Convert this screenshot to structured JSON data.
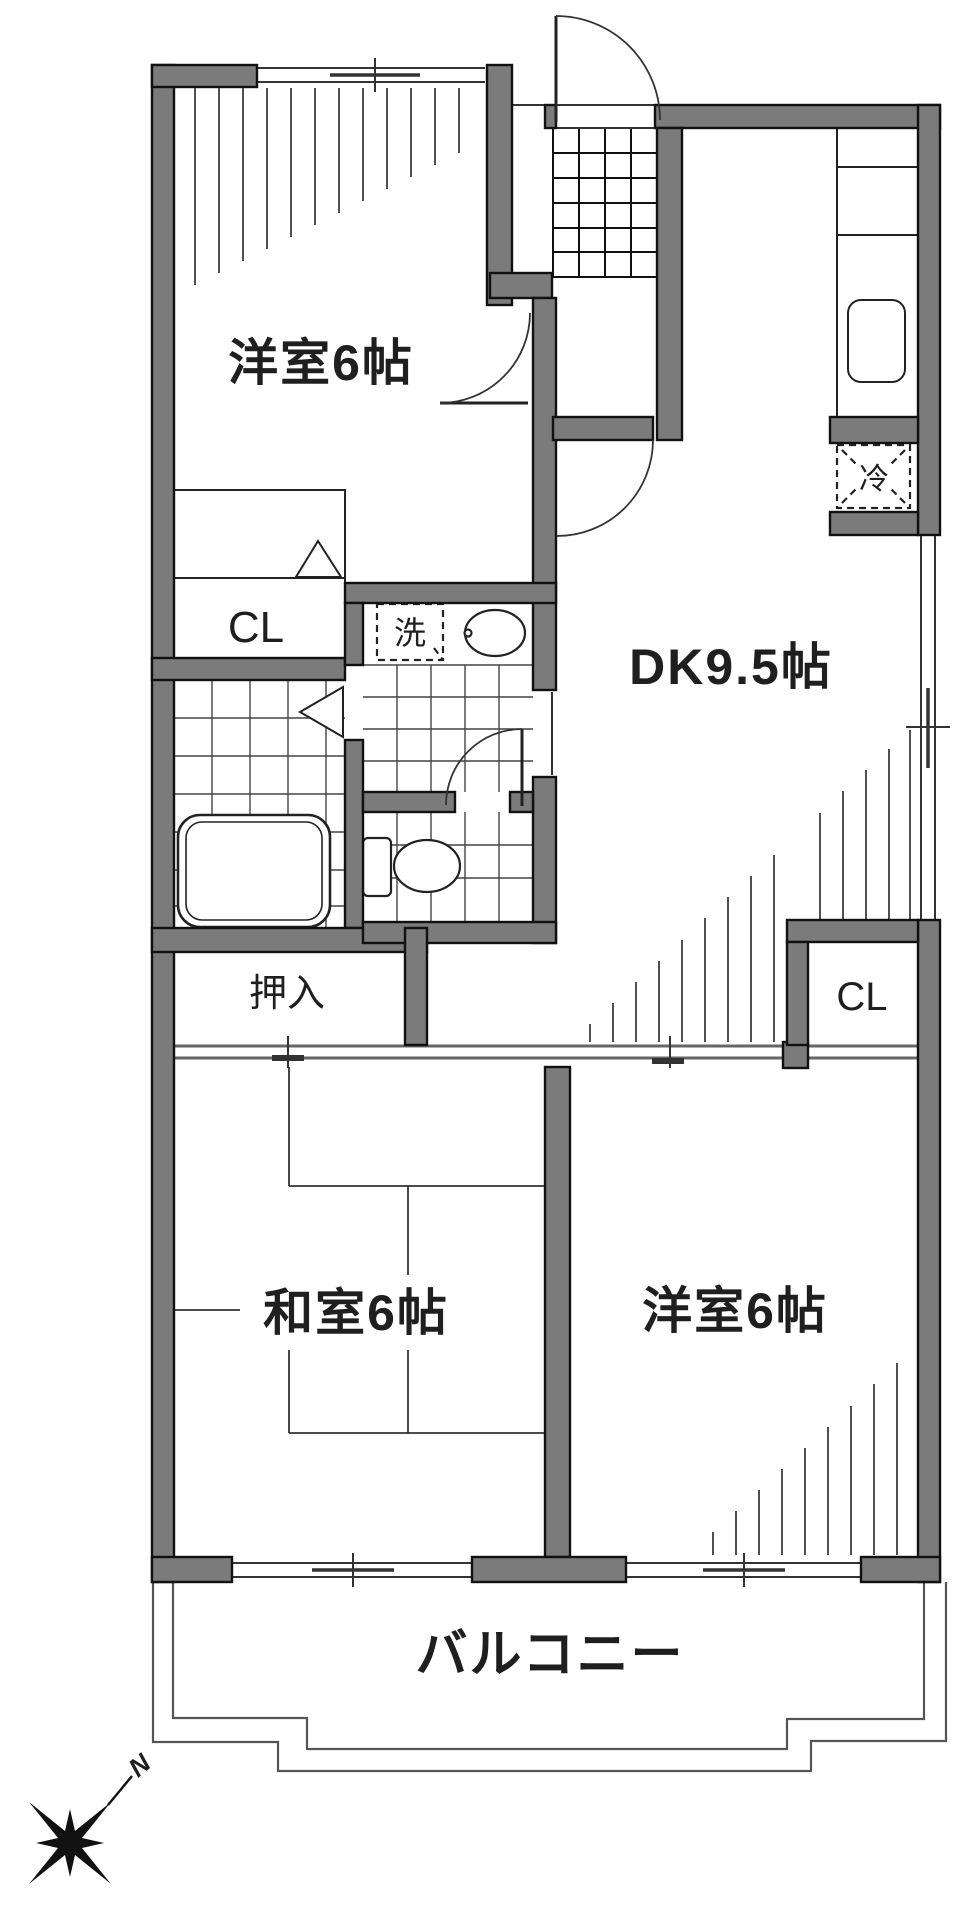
{
  "title": "apartment-floor-plan",
  "rooms": [
    {
      "name": "bedroom-nw",
      "label": "洋室6帖"
    },
    {
      "name": "dining-kitchen",
      "label": "DK9.5帖"
    },
    {
      "name": "japanese-room",
      "label": "和室6帖"
    },
    {
      "name": "bedroom-se",
      "label": "洋室6帖"
    },
    {
      "name": "balcony",
      "label": "バルコニー"
    }
  ],
  "closets": {
    "closet_nw": "CL",
    "closet_se": "CL",
    "oshiire": "押入"
  },
  "appliances": {
    "washer": "洗",
    "refrigerator": "冷"
  },
  "compass": {
    "north": "N"
  },
  "colors": {
    "wall_fill": "#7b7b7b",
    "wall_outline": "#111111",
    "line": "#222222",
    "tile_line": "#444444",
    "hatch_line": "#3d3d3d"
  }
}
